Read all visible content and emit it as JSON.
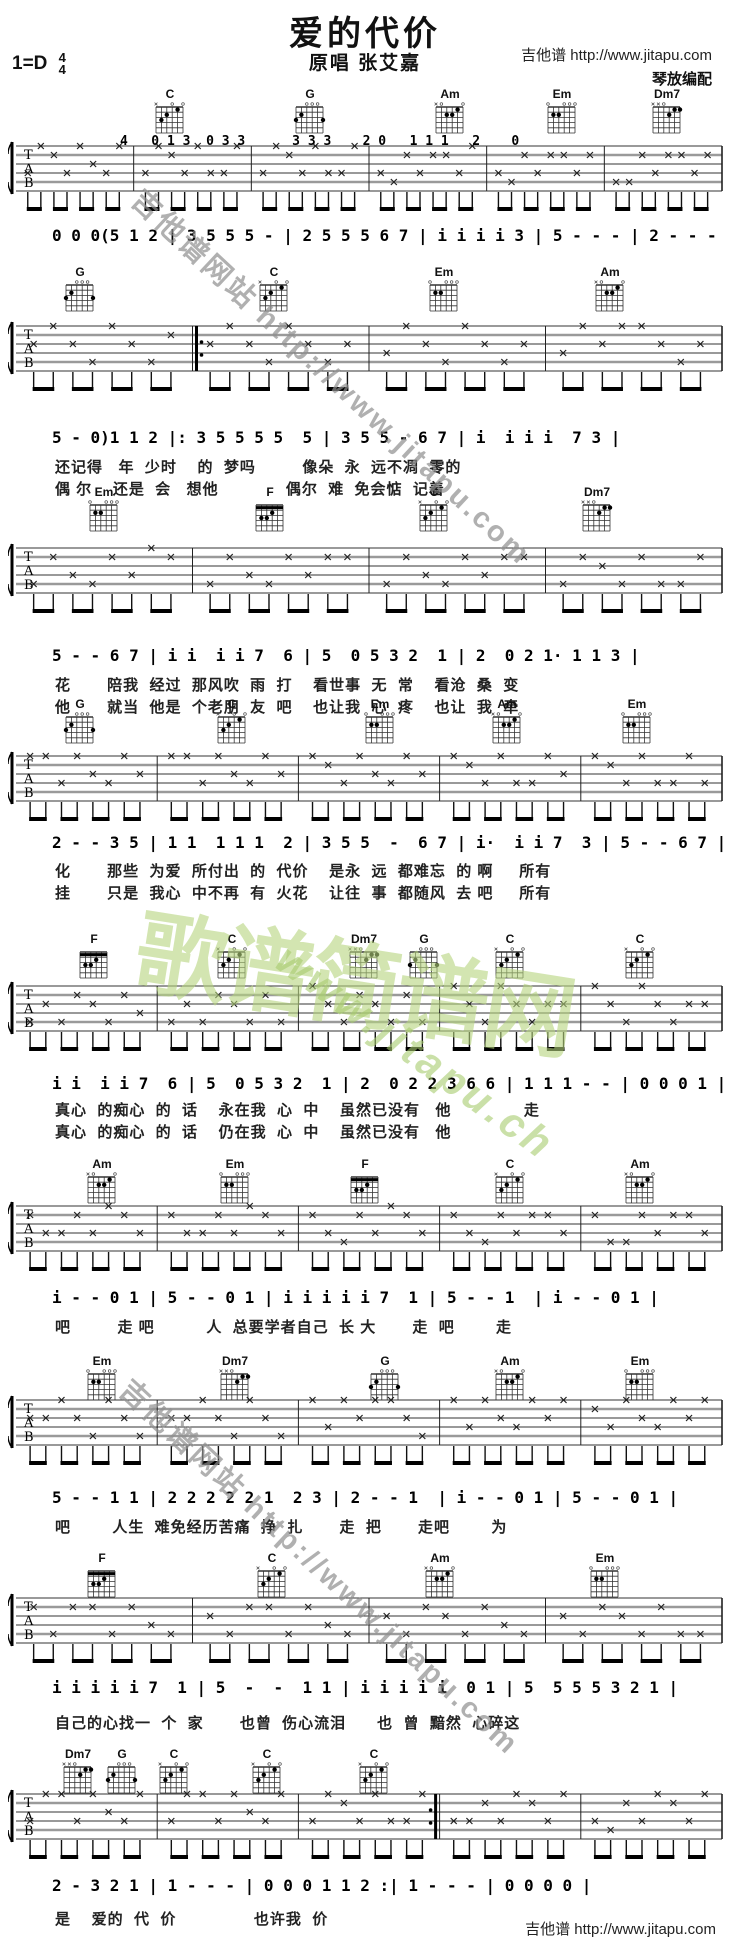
{
  "header": {
    "title": "爱的代价",
    "subtitle": "原唱 张艾嘉",
    "site": "吉他谱 http://www.jitapu.com",
    "arranger": "琴放编配",
    "key": "1=D",
    "time_num": "4",
    "time_den": "4"
  },
  "watermarks": {
    "diag_top": "吉他谱网站 http://www.jitapu.com",
    "diag_bottom": "吉他谱网站 http://www.jitapu.com",
    "green_big": "歌谱简谱网",
    "green_small": "www.jitapu.ch"
  },
  "staff_labels": [
    "T",
    "A",
    "B"
  ],
  "footer": {
    "site": "吉他谱 http://www.jitapu.com"
  },
  "systems": [
    {
      "chords": [
        {
          "name": "C",
          "x": 148
        },
        {
          "name": "G",
          "x": 288
        },
        {
          "name": "Am",
          "x": 428
        },
        {
          "name": "Em",
          "x": 540
        },
        {
          "name": "Dm7",
          "x": 645
        }
      ],
      "intro_tab": "4   0 1 3  0 3 3      3 3 3    2 0   1 1 1   2    0",
      "melody": "0 0 0(5 1 2 | 3 5 5 5 - | 2 5 5 5 6 7 | i i i i 3 | 5 - - - | 2 - - - |",
      "lyrics": []
    },
    {
      "chords": [
        {
          "name": "G",
          "x": 58
        },
        {
          "name": "C",
          "x": 252
        },
        {
          "name": "Em",
          "x": 422
        },
        {
          "name": "Am",
          "x": 588
        }
      ],
      "melody": "5 - 0)1 1 2 |: 3 5 5 5 5  5 | 3 5 5 - 6 7 | i  i i i  7 3 |",
      "lyrics": [
        "还记得   年  少时    的  梦吗         像朵  永  远不凋  零的",
        "偶 尔    还是  会   想他             偶尔  难  免会惦  记着"
      ]
    },
    {
      "chords": [
        {
          "name": "Em",
          "x": 82
        },
        {
          "name": "F",
          "x": 248
        },
        {
          "name": "C",
          "x": 412
        },
        {
          "name": "Dm7",
          "x": 575
        }
      ],
      "melody": "5 - - 6 7 | i i  i i 7  6 | 5  0 5 3 2  1 | 2  0 2 1· 1 1 3 |",
      "lyrics": [
        "花       陪我  经过  那风吹  雨  打    看世事  无  常    看沧  桑  变",
        "他       就当  他是  个老朋  友  吧    也让我  心  疼    也让  我  牵"
      ]
    },
    {
      "chords": [
        {
          "name": "G",
          "x": 58
        },
        {
          "name": "C",
          "x": 210
        },
        {
          "name": "Em",
          "x": 358
        },
        {
          "name": "Am",
          "x": 485
        },
        {
          "name": "Em",
          "x": 615
        }
      ],
      "melody": "2 - - 3 5 | 1 1  1 1 1  2 | 3 5 5  -  6 7 | i·  i i 7  3 | 5 - - 6 7 |",
      "lyrics": [
        "化       那些  为爱  所付出  的  代价    是永  远  都难忘  的 啊     所有",
        "挂       只是  我心  中不再  有  火花    让往  事  都随风  去 吧     所有"
      ]
    },
    {
      "chords": [
        {
          "name": "F",
          "x": 72
        },
        {
          "name": "C",
          "x": 210
        },
        {
          "name": "Dm7",
          "x": 342
        },
        {
          "name": "G",
          "x": 402
        },
        {
          "name": "C",
          "x": 488
        },
        {
          "name": "C",
          "x": 618
        }
      ],
      "melody": "i i  i i 7  6 | 5  0 5 3 2  1 | 2  0 2 2 3 6 6 | 1 1 1 - - | 0 0 0 1 |",
      "lyrics": [
        "真心  的痴心  的  话    永在我  心  中    虽然已没有   他              走",
        "真心  的痴心  的  话    仍在我  心  中    虽然已没有   他"
      ]
    },
    {
      "chords": [
        {
          "name": "Am",
          "x": 80
        },
        {
          "name": "Em",
          "x": 213
        },
        {
          "name": "F",
          "x": 343
        },
        {
          "name": "C",
          "x": 488
        },
        {
          "name": "Am",
          "x": 618
        }
      ],
      "melody": "i - - 0 1 | 5 - - 0 1 | i i i i i 7  1 | 5 - - 1  | i - - 0 1 |",
      "lyrics": [
        "吧         走 吧          人  总要学者自己  长 大       走  吧        走"
      ]
    },
    {
      "chords": [
        {
          "name": "Em",
          "x": 80
        },
        {
          "name": "Dm7",
          "x": 213
        },
        {
          "name": "G",
          "x": 363
        },
        {
          "name": "Am",
          "x": 488
        },
        {
          "name": "Em",
          "x": 618
        }
      ],
      "melody": "5 - - 1 1 | 2 2 2 2 2 1  2 3 | 2 - - 1  | i - - 0 1 | 5 - - 0 1 |",
      "lyrics": [
        "吧        人生  难免经历苦痛  挣  扎       走  把       走吧        为"
      ]
    },
    {
      "chords": [
        {
          "name": "F",
          "x": 80
        },
        {
          "name": "C",
          "x": 250
        },
        {
          "name": "Am",
          "x": 418
        },
        {
          "name": "Em",
          "x": 583
        }
      ],
      "melody": "i i i i i 7  1 | 5  -  -  1 1 | i i i i i  0 1 | 5  5 5 5 3 2 1 |",
      "lyrics": [
        "自己的心找一  个  家       也曾  伤心流泪      也  曾  黯然  心碎这"
      ]
    },
    {
      "chords": [
        {
          "name": "Dm7",
          "x": 56
        },
        {
          "name": "G",
          "x": 100
        },
        {
          "name": "C",
          "x": 152
        },
        {
          "name": "C",
          "x": 245
        },
        {
          "name": "C",
          "x": 352
        }
      ],
      "melody": "2 - 3 2 1 | 1 - - - | 0 0 0 1 1 2 :| 1 - - - | 0 0 0 0 |",
      "lyrics": [
        "是    爱的  代  价               也许我  价"
      ]
    }
  ]
}
